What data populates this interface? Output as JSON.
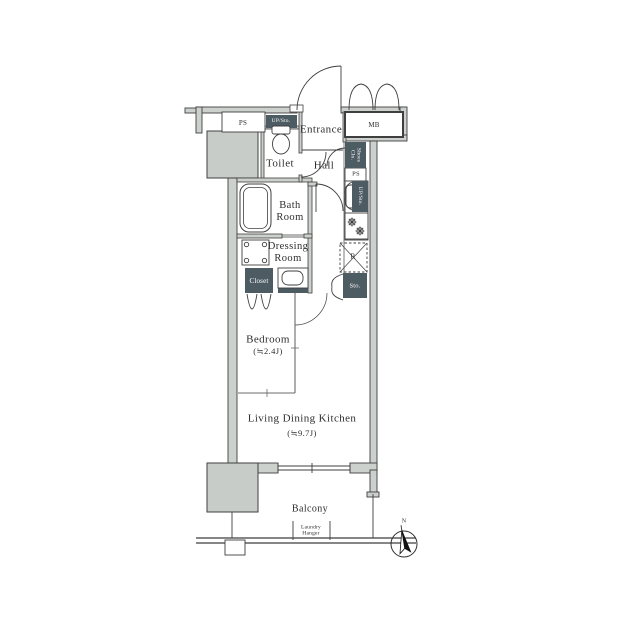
{
  "floorplan": {
    "rooms": {
      "entrance": "Entrance",
      "hall": "Hall",
      "toilet": "Toilet",
      "bath_room_lines": [
        "Bath",
        "Room"
      ],
      "dressing_room_lines": [
        "Dressing",
        "Room"
      ],
      "bedroom_name": "Bedroom",
      "bedroom_size": "(≒2.4J)",
      "ldk_name": "Living Dining Kitchen",
      "ldk_size": "(≒9.7J)",
      "balcony": "Balcony"
    },
    "fixtures": {
      "ps_top": "PS",
      "ps_right": "PS",
      "meter_box": "MB",
      "up_storage_top": "UP/Sto.",
      "up_storage_right": "UP/Sto.",
      "shoes_closet_lines": [
        "Shoes",
        "Clo."
      ],
      "closet": "Closet",
      "storage": "Sto.",
      "refrigerator_mark": "R",
      "laundry_hanger_lines": [
        "Laundry",
        "Hanger"
      ]
    },
    "compass": {
      "north": "N"
    },
    "colors": {
      "dark_box": "#4d5c63",
      "wall_fill": "#cdd1ce",
      "line": "#3f3f3f",
      "background": "#ffffff"
    }
  }
}
